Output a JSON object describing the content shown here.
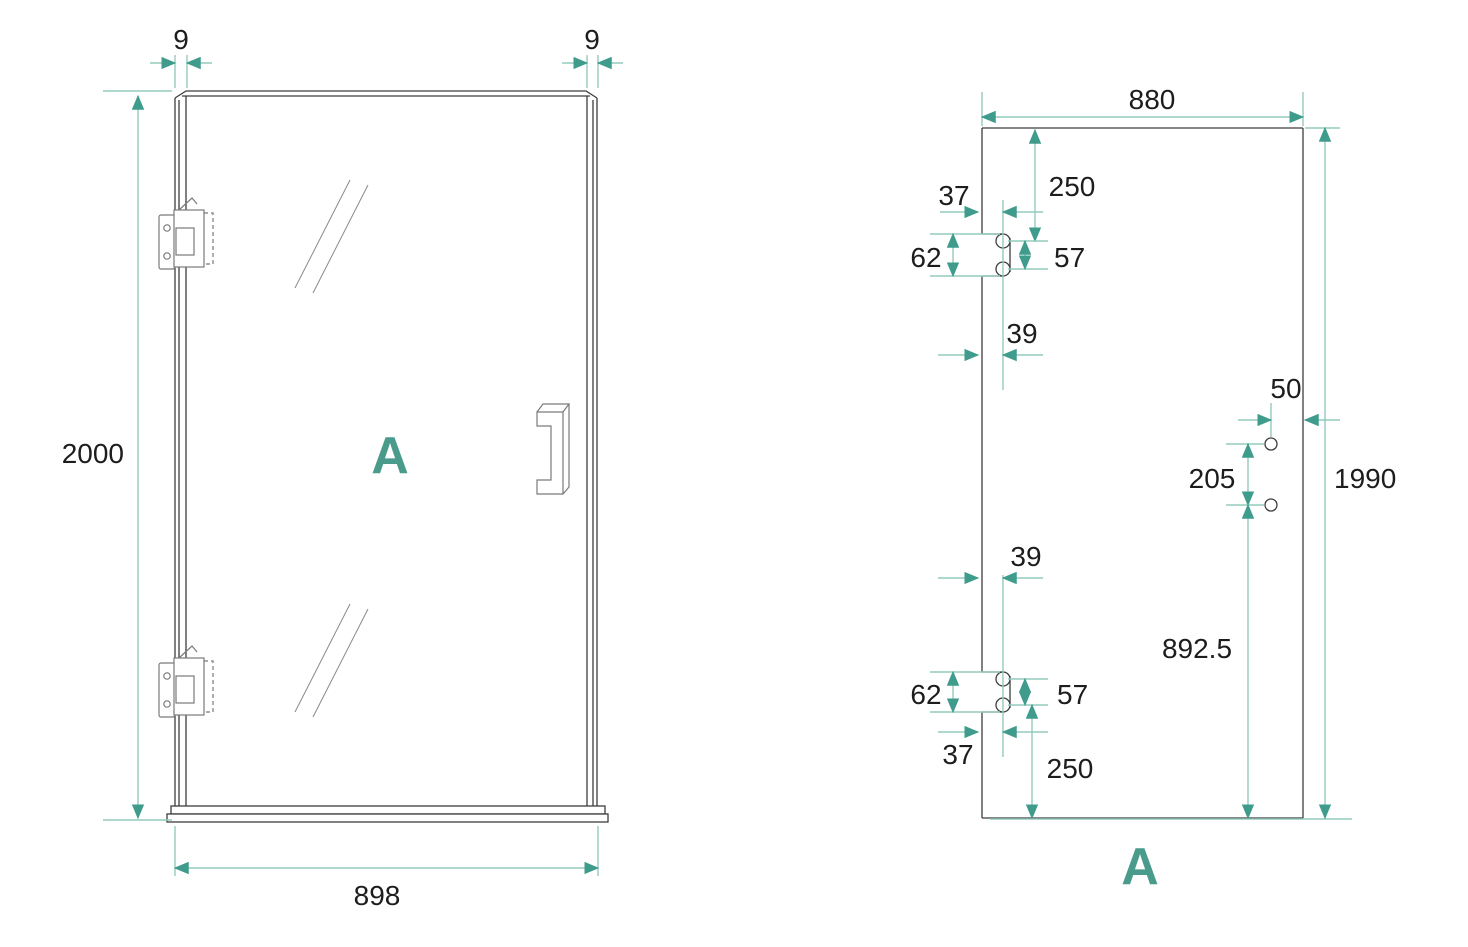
{
  "colors": {
    "accent": "#4a9b8c",
    "arrow": "#3f9c8c",
    "dim_line": "#93cabd",
    "outline": "#3d3d3d",
    "hardware": "#7a7a7a",
    "shine": "#8a8a8a",
    "text": "#1d1d1d"
  },
  "left_view": {
    "label": "A",
    "dims": {
      "gap_left": "9",
      "gap_right": "9",
      "height": "2000",
      "width": "898"
    }
  },
  "right_view": {
    "label": "A",
    "dims": {
      "width": "880",
      "height": "1990",
      "top_hinge": {
        "from_top": "250",
        "edge_inset": "37",
        "center_inset": "39",
        "cutout_height": "62",
        "hole_spacing": "57"
      },
      "bottom_hinge": {
        "from_bottom": "250",
        "edge_inset": "37",
        "center_inset": "39",
        "cutout_height": "62",
        "hole_spacing": "57"
      },
      "handle_holes": {
        "from_edge": "50",
        "spacing": "205",
        "from_bottom": "892.5"
      }
    }
  }
}
